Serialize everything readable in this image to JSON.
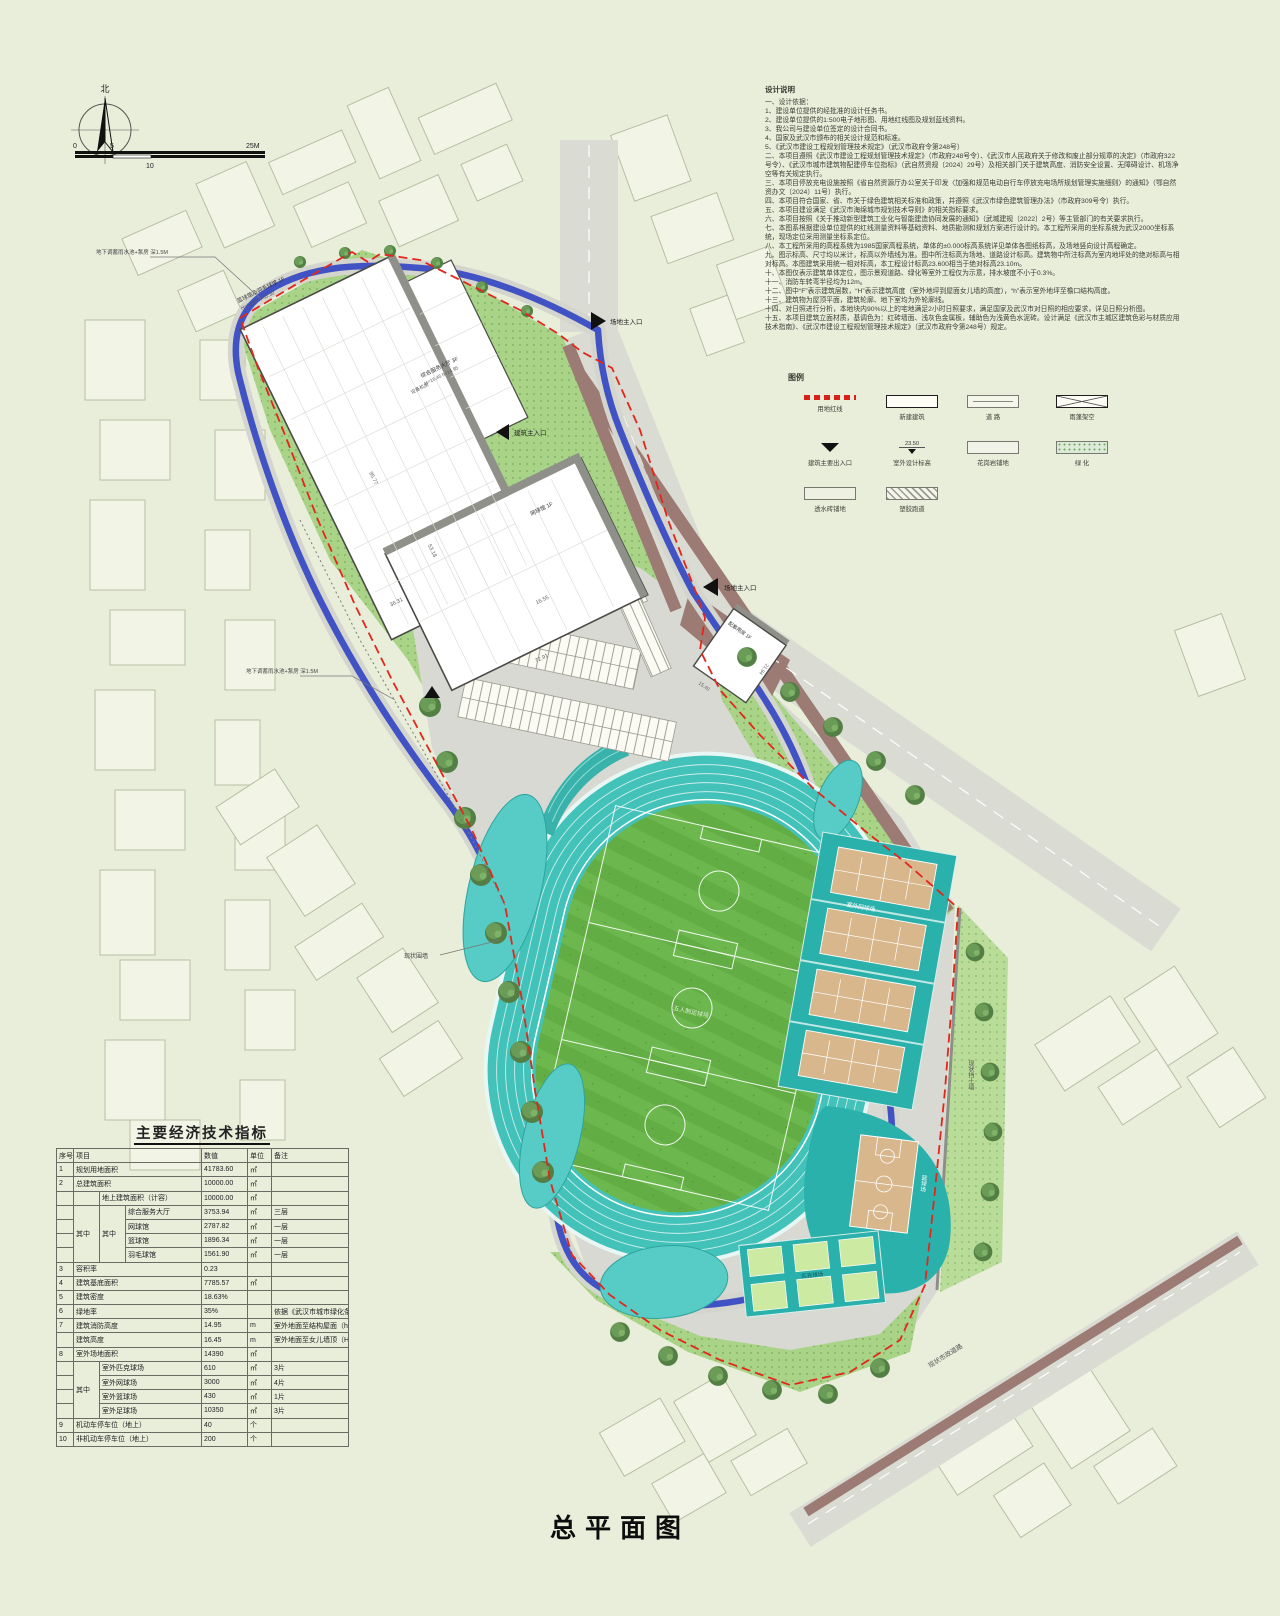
{
  "page": {
    "title": "总平面图"
  },
  "north": {
    "label": "北"
  },
  "scalebar": {
    "t0": "0",
    "t5": "5",
    "t10": "10",
    "t25": "25M"
  },
  "notes": {
    "title": "设计说明",
    "lines": [
      "一、设计依据：",
      "1、建设单位提供的经批准的设计任务书。",
      "2、建设单位提供的1:500电子地形图、用地红线图及规划蓝线资料。",
      "3、我公司与建设单位签定的设计合同书。",
      "4、国家及武汉市颁布的相关设计规范和标准。",
      "5、《武汉市建设工程规划管理技术规定》（武汉市政府令第248号）",
      "二、本项目遵照《武汉市建设工程规划管理技术规定》（市政府248号令）、《武汉市人民政府关于修改和废止部分规章的决定》（市政府322号令）、《武汉市城市建筑物配建停车位指标》（武自然资规〔2024〕29号）及相关部门关于建筑高度、消防安全设置、无障碍设计、机场净空等有关规定执行。",
      "三、本项目停放充电设施按照《省自然资源厅办公室关于印发〈加强和规范电动自行车停放充电场所规划管理实施细则〉的通知》（鄂自然资办文〔2024〕11号）执行。",
      "四、本项目符合国家、省、市关于绿色建筑相关标准和政策，并遵照《武汉市绿色建筑管理办法》（市政府309号令）执行。",
      "五、本项目建设满足《武汉市海绵城市规划技术导则》的相关指标要求。",
      "六、本项目按照《关于推动新型建筑工业化与智能建造协同发展的通知》（武城建规〔2022〕2号）等主管部门的有关要求执行。",
      "七、本图系根据建设单位提供的红线测量资料等基础资料、地质勘测和规划方案进行设计的。本工程所采用的坐标系统为武汉2000坐标系统，现场定位采用测量坐标系定位。",
      "八、本工程所采用的高程系统为1985国家高程系统，单体的±0.000标高系统详见单体各图纸标高，及场地竖向设计高程确定。",
      "九、图示标高、尺寸均以米计，标高以外墙线为准。图中所注标高为场地、道路设计标高。建筑物中所注标高为室内地坪处的绝对标高与相对标高。本图建筑采用统一相对标高，本工程设计标高23.600相当于绝对标高23.10m。",
      "十、本图仅表示建筑单体定位，图示景观道路、绿化等室外工程仅为示意，排水坡度不小于0.3%。",
      "十一、消防车转弯半径均为12m。",
      "十二、图中“F”表示建筑层数，“H”表示建筑高度（室外地坪到屋面女儿墙的高度），“h”表示室外地坪至檐口结构高度。",
      "十三、建筑物为屋顶平面，建筑轮廓、地下室均为外轮廓线。",
      "十四、对日照进行分析，本地块内90%以上的宅地满足2小时日照要求，满足国家及武汉市对日照的相应要求，详见日照分析图。",
      "十五、本项目建筑立面材质，基调色为：红砖墙面、浅灰色金属板，辅助色为浅黄色水泥砖。设计满足《武汉市主城区建筑色彩与材质应用技术指南》、《武汉市建设工程规划管理技术规定》（武汉市政府令第248号）规定。"
    ]
  },
  "legend": {
    "title": "图例",
    "items": [
      {
        "label": "用地红线"
      },
      {
        "label": "新建建筑"
      },
      {
        "label": "道  路"
      },
      {
        "label": "雨蓬架空"
      },
      {
        "label": "建筑主要出入口"
      },
      {
        "label": "室外设计标高",
        "value": "23.50"
      },
      {
        "label": "花岗岩铺地"
      },
      {
        "label": "绿  化"
      },
      {
        "label": "透水砖铺地"
      },
      {
        "label": "塑胶跑道"
      }
    ]
  },
  "table": {
    "title": "主要经济技术指标",
    "h_no": "序号",
    "h_item": "项目",
    "h_value": "数值",
    "h_unit": "单位",
    "h_note": "备注",
    "qizhong": "其中",
    "rows": {
      "r1": {
        "no": "1",
        "item": "规划用地面积",
        "value": "41783.60",
        "unit": "㎡",
        "note": ""
      },
      "r2": {
        "no": "2",
        "item": "总建筑面积",
        "value": "10000.00",
        "unit": "㎡",
        "note": ""
      },
      "r3": {
        "item": "地上建筑面积（计容）",
        "value": "10000.00",
        "unit": "㎡",
        "note": ""
      },
      "r4": {
        "item": "综合服务大厅",
        "value": "3753.94",
        "unit": "㎡",
        "note": "三层"
      },
      "r5": {
        "item": "网球馆",
        "value": "2787.82",
        "unit": "㎡",
        "note": "一层"
      },
      "r6": {
        "item": "篮球馆",
        "value": "1896.34",
        "unit": "㎡",
        "note": "一层"
      },
      "r7": {
        "item": "羽毛球馆",
        "value": "1561.90",
        "unit": "㎡",
        "note": "一层"
      },
      "r8": {
        "no": "3",
        "item": "容积率",
        "value": "0.23",
        "unit": "",
        "note": ""
      },
      "r9": {
        "no": "4",
        "item": "建筑基底面积",
        "value": "7785.57",
        "unit": "㎡",
        "note": ""
      },
      "r10": {
        "no": "5",
        "item": "建筑密度",
        "value": "18.63%",
        "unit": "",
        "note": ""
      },
      "r11": {
        "no": "6",
        "item": "绿地率",
        "value": "35%",
        "unit": "",
        "note": "依据《武汉市城市绿化条例》执行"
      },
      "r12": {
        "no": "7",
        "item": "建筑消防高度",
        "value": "14.95",
        "unit": "m",
        "note": "室外地面至结构屋面（h）"
      },
      "r13": {
        "item": "建筑高度",
        "value": "16.45",
        "unit": "m",
        "note": "室外地面至女儿墙顶（H）"
      },
      "r14": {
        "no": "8",
        "item": "室外场地面积",
        "value": "14390",
        "unit": "㎡",
        "note": ""
      },
      "r15": {
        "item": "室外匹克球场",
        "value": "610",
        "unit": "㎡",
        "note": "3片"
      },
      "r16": {
        "item": "室外网球场",
        "value": "3000",
        "unit": "㎡",
        "note": "4片"
      },
      "r17": {
        "item": "室外篮球场",
        "value": "430",
        "unit": "㎡",
        "note": "1片"
      },
      "r18": {
        "item": "室外足球场",
        "value": "10350",
        "unit": "㎡",
        "note": "3片"
      },
      "r19": {
        "no": "9",
        "item": "机动车停车位（地上）",
        "value": "40",
        "unit": "个",
        "note": ""
      },
      "r20": {
        "no": "10",
        "item": "非机动车停车位（地上）",
        "value": "200",
        "unit": "个",
        "note": ""
      }
    }
  },
  "plan": {
    "entrance_site": "场地主入口",
    "entrance_building": "建筑主入口",
    "bldg_complex_name": "篮球馆及羽毛球馆 1F",
    "bldg_complex_elev": "H=14.95 h=11.30",
    "bldg_hall_name": "综合服务大厅 3F",
    "bldg_hall_elev": "H=16.45 h=14.95",
    "bldg_tennis_name": "网球馆 1F",
    "equipment_room": "设备机房",
    "aux_building": "配套用房 1F",
    "tennis_courts": "室外网球场",
    "basketball_court": "篮球场",
    "pickleball_court": "匹克球场",
    "football_field": "五人制足球场",
    "existing_wall": "现状围墙",
    "existing_road": "现状市政道路",
    "retaining_wall": "现状挡土墙",
    "rain_tank": "地下调蓄雨水池+泵房 深1.5M",
    "dims": {
      "d1": "95.77",
      "d2": "72.91",
      "d3": "53.18",
      "d4": "36.31",
      "d5": "16.55",
      "d6": "21.94",
      "d7": "15.40"
    }
  },
  "colors": {
    "track_teal": "#43c2ba",
    "court_tan": "#d8b78d",
    "loop_blue": "#4152c5",
    "boundary_red": "#e3261b",
    "planting_green": "#a9d488",
    "paving_brown": "#9b7b74"
  }
}
